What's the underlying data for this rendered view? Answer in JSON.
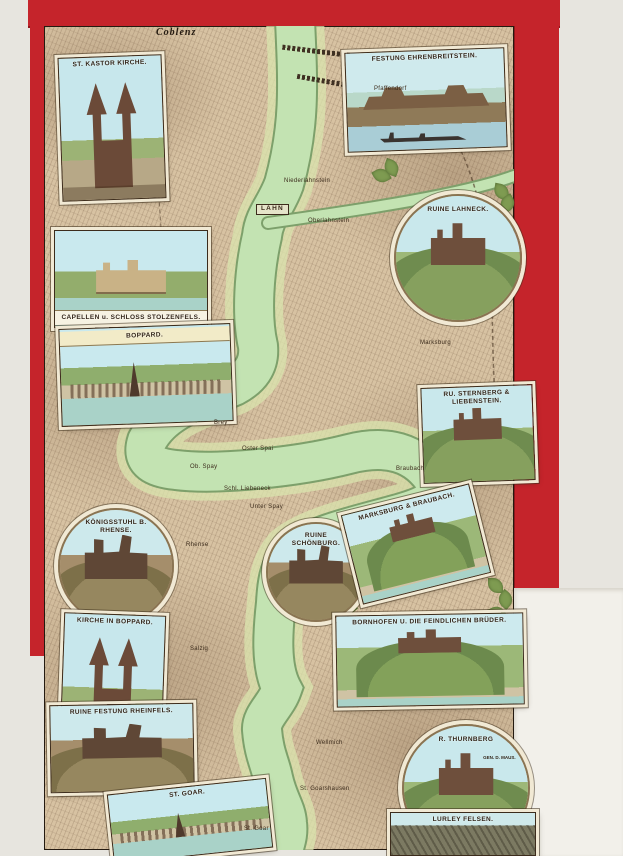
{
  "palette": {
    "cover_red": "#c5242b",
    "map_tan": "#d7c2a2",
    "river_green": "#c3e3b2",
    "banner_cream": "#f1e9d4",
    "paper": "#f2f0ea"
  },
  "vignettes": [
    {
      "id": "st-kastor-kirche",
      "label": "ST. KASTOR KIRCHE.",
      "shape": "rect",
      "scene": "church",
      "x": 60,
      "y": 56,
      "w": 104,
      "h": 144,
      "rot": -2
    },
    {
      "id": "festung-ehrenbreitstein",
      "label": "FESTUNG EHRENBREITSTEIN.",
      "shape": "rect",
      "scene": "fortress",
      "x": 346,
      "y": 50,
      "w": 160,
      "h": 100,
      "rot": -2
    },
    {
      "id": "ruine-lahneck",
      "label": "RUINE LAHNECK.",
      "shape": "circle",
      "scene": "castle-hill",
      "x": 394,
      "y": 194,
      "w": 128,
      "h": 128,
      "rot": 0
    },
    {
      "id": "capellen-schloss-stolzenfels",
      "label": "CAPELLEN u. SCHLOSS STOLZENFELS.",
      "shape": "rect",
      "scene": "river-castle",
      "x": 54,
      "y": 230,
      "w": 154,
      "h": 98,
      "rot": 0,
      "labelPos": "bottom",
      "labelStyle": "band"
    },
    {
      "id": "boppard-panorama",
      "label": "BOPPARD.",
      "shape": "rect",
      "scene": "river-town",
      "x": 60,
      "y": 326,
      "w": 172,
      "h": 98,
      "rot": -2,
      "labelStyle": "band"
    },
    {
      "id": "sternberg-liebenstein",
      "label": "RU. STERNBERG & LIEBENSTEIN.",
      "shape": "rect",
      "scene": "castle-hill",
      "x": 422,
      "y": 386,
      "w": 112,
      "h": 96,
      "rot": -2
    },
    {
      "id": "koenigsstuhl-rhense",
      "label": "KÖNIGSSTUHL B. RHENSE.",
      "shape": "circle",
      "scene": "ruin",
      "x": 58,
      "y": 508,
      "w": 116,
      "h": 116,
      "rot": 0
    },
    {
      "id": "ruine-schoenburg",
      "label": "RUINE SCHÖNBURG.",
      "shape": "circle",
      "scene": "ruin",
      "x": 266,
      "y": 522,
      "w": 100,
      "h": 100,
      "rot": 0
    },
    {
      "id": "marksburg-braubach",
      "label": "MARKSBURG & BRAUBACH.",
      "shape": "rect",
      "scene": "hill-town",
      "x": 350,
      "y": 498,
      "w": 132,
      "h": 92,
      "rot": -14
    },
    {
      "id": "kirche-in-boppard",
      "label": "KIRCHE IN BOPPARD.",
      "shape": "rect",
      "scene": "church",
      "x": 62,
      "y": 614,
      "w": 102,
      "h": 128,
      "rot": 2
    },
    {
      "id": "bornhofen-feindliche-brueder",
      "label": "BORNHOFEN U. DIE FEINDLICHEN BRÜDER.",
      "shape": "rect",
      "scene": "hill-town",
      "x": 336,
      "y": 614,
      "w": 188,
      "h": 92,
      "rot": -1
    },
    {
      "id": "ruine-festung-rheinfels",
      "label": "RUINE FESTUNG RHEINFELS.",
      "shape": "rect",
      "scene": "ruin",
      "x": 50,
      "y": 704,
      "w": 144,
      "h": 88,
      "rot": -1
    },
    {
      "id": "ruine-thurnberg",
      "label": "R. THURNBERG",
      "sublabel": "GEN. D. MAUS.",
      "shape": "circle",
      "scene": "castle-hill",
      "x": 402,
      "y": 724,
      "w": 128,
      "h": 128,
      "rot": 0
    },
    {
      "id": "st-goar-panorama",
      "label": "ST. GOAR.",
      "shape": "rect",
      "scene": "river-town",
      "x": 110,
      "y": 786,
      "w": 160,
      "h": 70,
      "rot": -6
    },
    {
      "id": "lurley-felsen",
      "label": "LURLEY FELSEN.",
      "shape": "rect",
      "scene": "rock",
      "x": 390,
      "y": 812,
      "w": 146,
      "h": 44,
      "rot": 0
    }
  ],
  "map_labels": [
    {
      "text": "Coblenz",
      "cls": "blackletter",
      "x": 156,
      "y": 28
    },
    {
      "text": "Pfaffendorf",
      "cls": "town",
      "x": 374,
      "y": 86
    },
    {
      "text": "Niederlahnstein",
      "cls": "town",
      "x": 284,
      "y": 178
    },
    {
      "text": "LAHN",
      "cls": "boxed",
      "x": 256,
      "y": 204
    },
    {
      "text": "Oberlahnstein",
      "cls": "town",
      "x": 308,
      "y": 218
    },
    {
      "text": "Marksburg",
      "cls": "town",
      "x": 420,
      "y": 340
    },
    {
      "text": "Brey",
      "cls": "town",
      "x": 214,
      "y": 420
    },
    {
      "text": "Oster Spai",
      "cls": "town",
      "x": 242,
      "y": 446
    },
    {
      "text": "Ob. Spay",
      "cls": "town",
      "x": 190,
      "y": 464
    },
    {
      "text": "Schl. Liebeneck",
      "cls": "town",
      "x": 224,
      "y": 486
    },
    {
      "text": "Unter Spay",
      "cls": "town",
      "x": 250,
      "y": 504
    },
    {
      "text": "Braubach",
      "cls": "town",
      "x": 396,
      "y": 466
    },
    {
      "text": "Rhense",
      "cls": "town",
      "x": 186,
      "y": 542
    },
    {
      "text": "Salzig",
      "cls": "town",
      "x": 190,
      "y": 646
    },
    {
      "text": "Wellmich",
      "cls": "town",
      "x": 316,
      "y": 740
    },
    {
      "text": "St. Goarshausen",
      "cls": "town",
      "x": 300,
      "y": 786
    },
    {
      "text": "St. Goar",
      "cls": "town",
      "x": 244,
      "y": 826
    }
  ]
}
